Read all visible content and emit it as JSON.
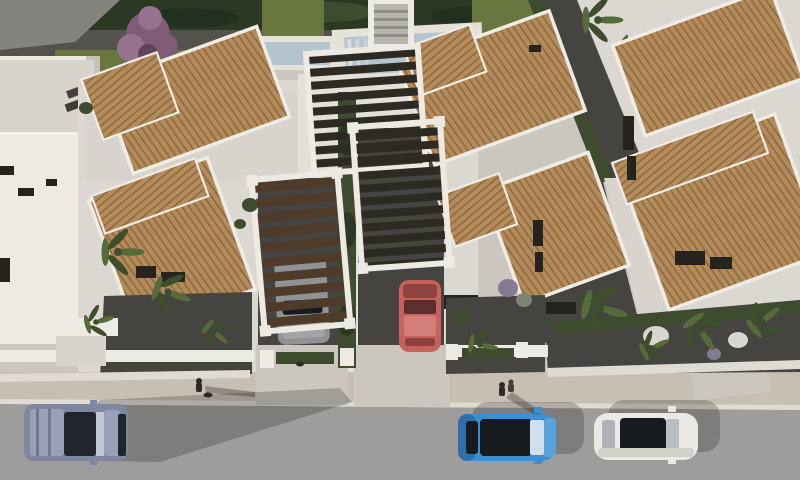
{
  "scene": {
    "type": "aerial-architectural-render",
    "subject": "bird's-eye 3D rendering of new-build white villas with terracotta tile roofs, slatted pergola carports, private pools, landscaped gravel gardens, palm trees and a street with parked cars",
    "objects": [
      "left-apartment-building",
      "left-villa-pair",
      "right-villa",
      "back-hedge",
      "three-swimming-pools",
      "central-pergola-roof",
      "left-carport-pergola",
      "right-carport-pergola",
      "silver-car-in-carport",
      "red-car-in-driveway",
      "purple-flowering-tree",
      "palm-trees",
      "front-garden-gravel",
      "low-white-walls",
      "sidewalk",
      "pedestrian-with-dog",
      "pedestrian-pair",
      "small-dog",
      "street",
      "gray-blue-suv",
      "blue-hatchback",
      "white-sedan"
    ]
  },
  "colors": {
    "concrete": "#cbc7bf",
    "patio": "#d8d4cd",
    "patio_light": "#e3e0d9",
    "wall_white": "#edeae4",
    "wall_light": "#dbd8d1",
    "wall_shade": "#c6c2bb",
    "road": "#9e9d9b",
    "sidewalk": "#c7c0b2",
    "curb": "#dfdbd2",
    "hedge": "#3d4b2f",
    "hedge_dark": "#2b3924",
    "lawn": "#67773f",
    "gravel": "#53524c",
    "gravel_dark": "#454440",
    "path_gray": "#84837d",
    "pool_deck": "#e7e2d8",
    "pool_water": "#b5c5d0",
    "pool_water_dark": "#a3b9c7",
    "roof_tile": "#b48b5a",
    "roof_tile_line": "#8d6940",
    "slat": "#2d2923",
    "slat_wood": "#4f3b29",
    "purple_tree": "#7e5c77",
    "purple_tree_light": "#97728e",
    "palm": "#566b3a",
    "palm_dark": "#3c4e2c",
    "bush_purple": "#847b93",
    "bush_white": "#d4d8d0",
    "window_dark": "#26221d",
    "suv_body": "#7d87a1",
    "suv_light": "#98a1b8",
    "suv_dark": "#21252c",
    "blue_car": "#3c8fd1",
    "blue_car_dark": "#2f6ea6",
    "white_car": "#ebe9e4",
    "glass": "#171a1e",
    "red_car": "#c6625b",
    "red_car_light": "#d37e76",
    "red_car_dark": "#8f4340",
    "silver_car": "#909296",
    "figure": "#2f2a24",
    "shadow": "rgba(35,33,30,0.25)",
    "shadow_strong": "rgba(30,28,26,0.32)"
  }
}
